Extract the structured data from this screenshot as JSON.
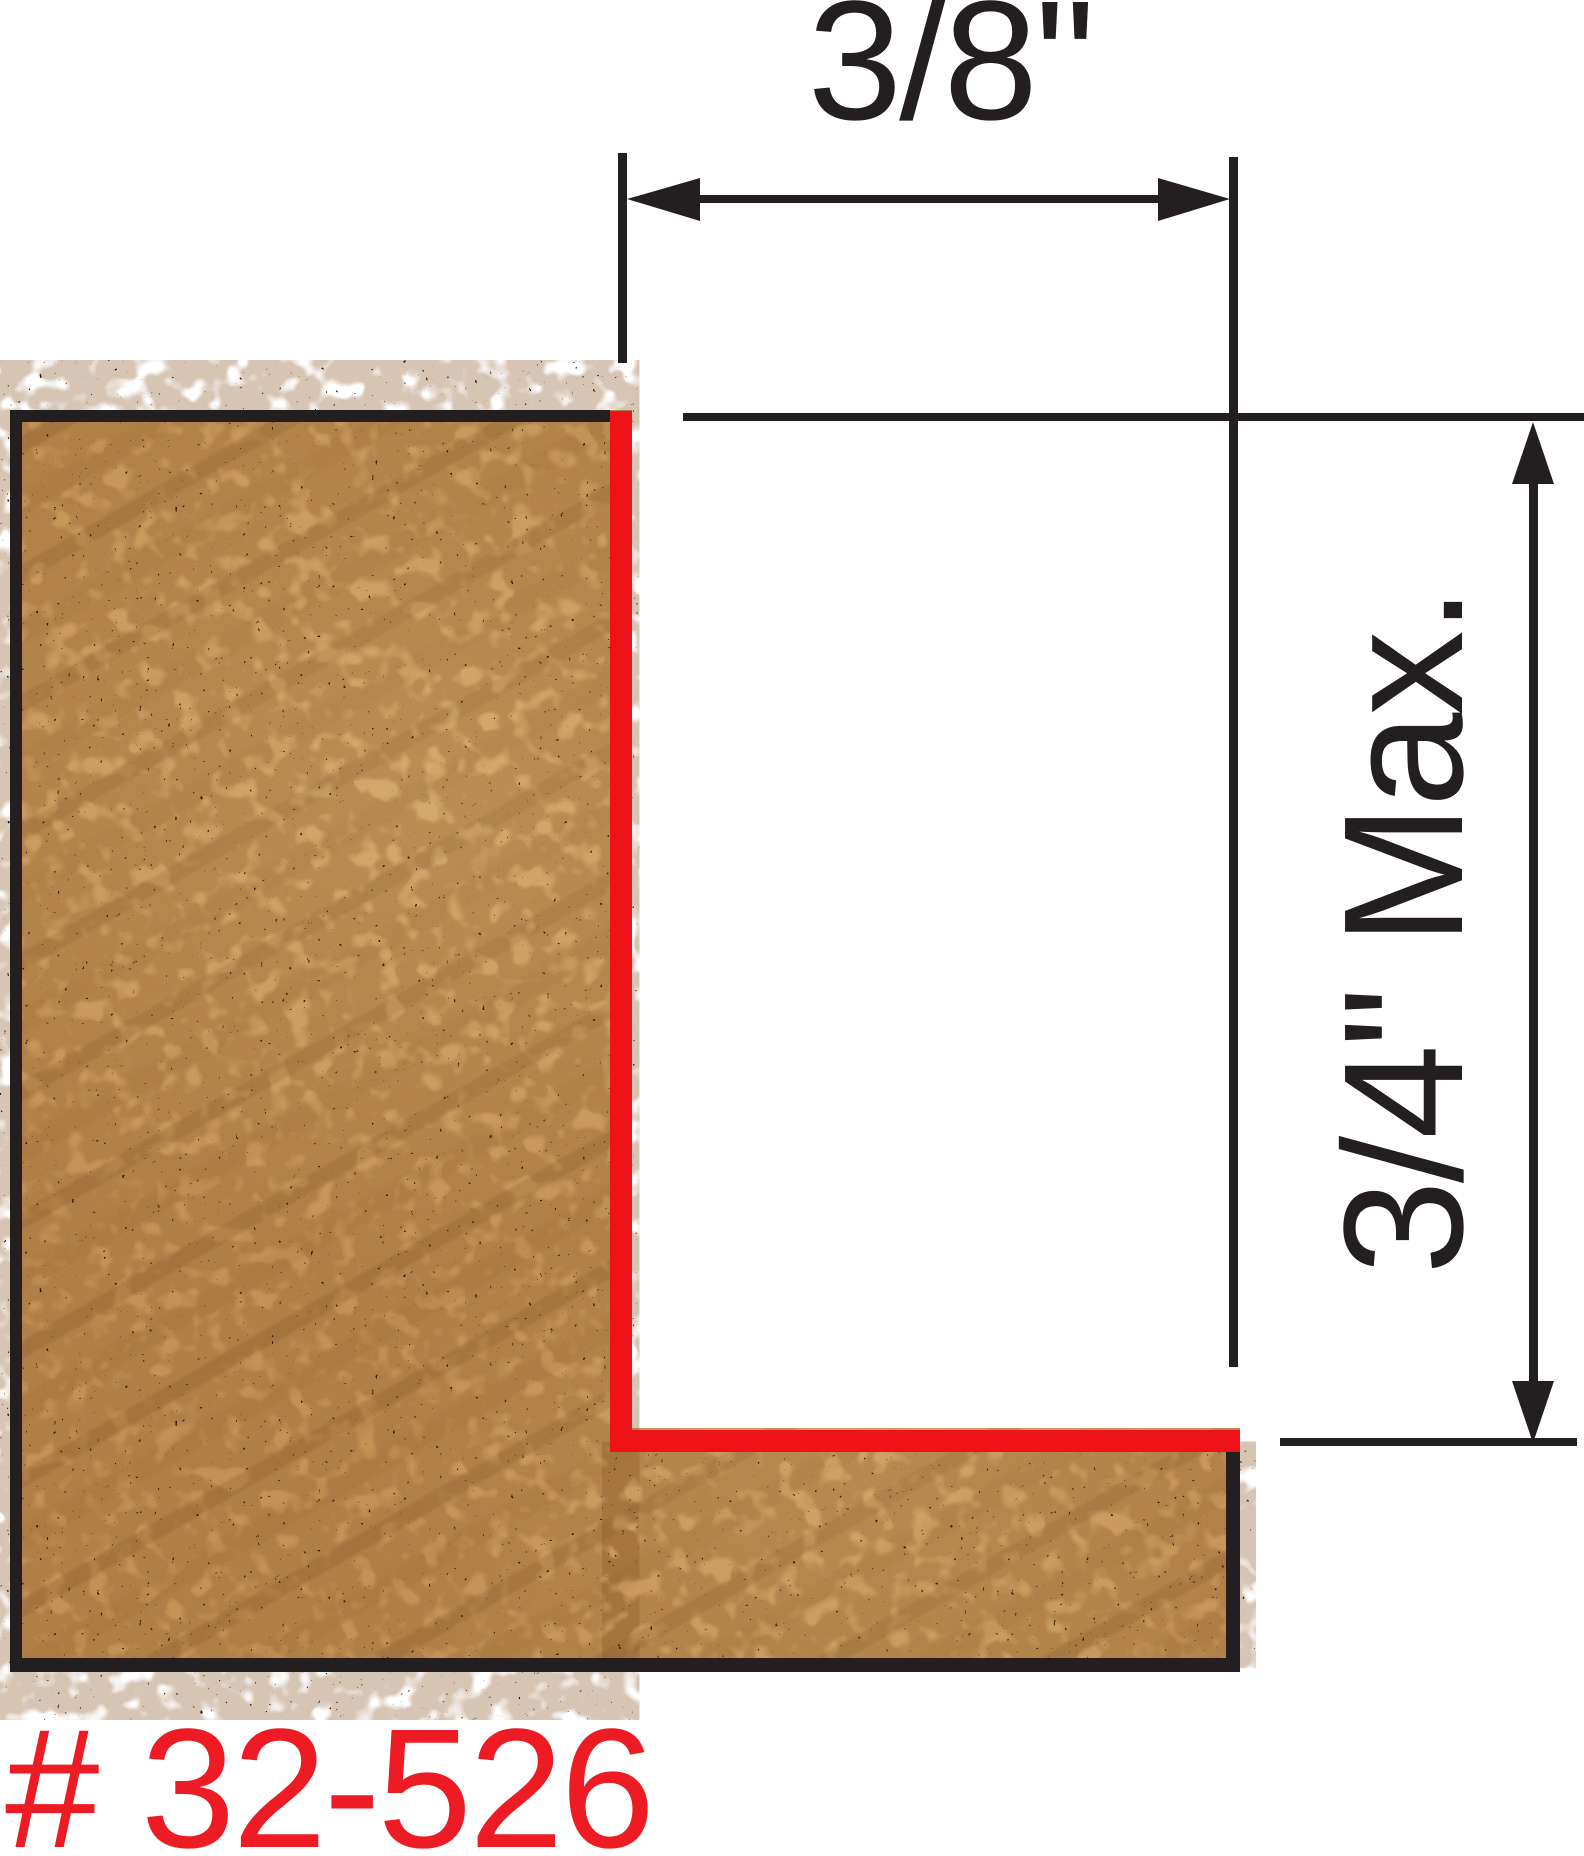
{
  "diagram": {
    "type": "rabbet-cut-dimension-diagram",
    "width_label": "3/8\"",
    "depth_label": "3/4\" Max.",
    "part_number": "# 32-526",
    "colors": {
      "line_black": "#231f20",
      "cut_red": "#ee1219",
      "part_number_red": "#ed1c24",
      "wood_base": "#c49257",
      "wood_speckle": "#2e1a08",
      "background": "#ffffff"
    }
  }
}
